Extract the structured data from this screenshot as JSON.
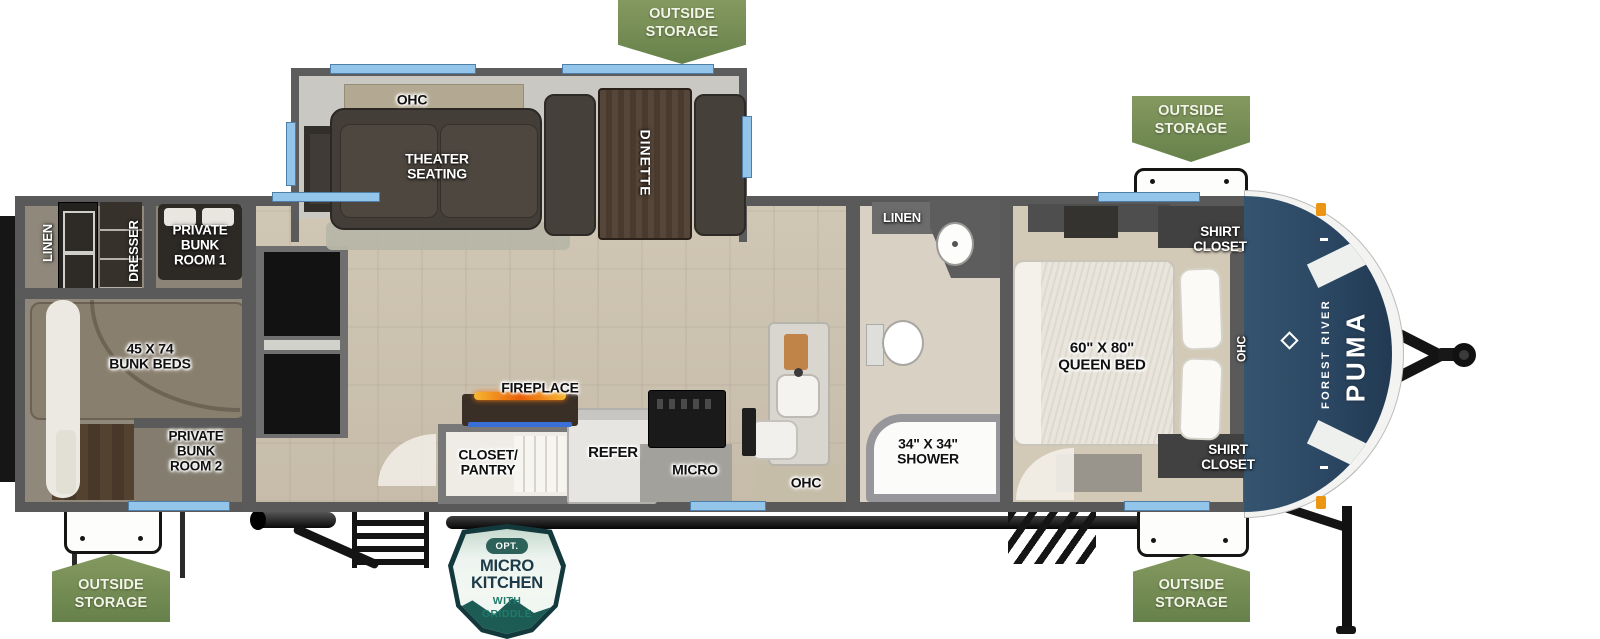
{
  "brand": {
    "maker": "FOREST RIVER",
    "model": "PUMA"
  },
  "badges": {
    "outside_storage": "OUTSIDE\nSTORAGE"
  },
  "option_badge": {
    "opt": "OPT.",
    "title": "MICRO\nKITCHEN",
    "subtitle": "WITH\nGRIDDLE"
  },
  "labels": {
    "linen_bunkhouse": "LINEN",
    "dresser": "DRESSER",
    "private_bunk_room_1": "PRIVATE\nBUNK\nROOM 1",
    "bunk_beds": "45 X 74\nBUNK BEDS",
    "private_bunk_room_2": "PRIVATE\nBUNK\nROOM 2",
    "ohc_slideout": "OHC",
    "theater_seating": "THEATER\nSEATING",
    "dinette": "DINETTE",
    "fireplace": "FIREPLACE",
    "closet_pantry": "CLOSET/\nPANTRY",
    "refer": "REFER",
    "micro": "MICRO",
    "ohc_kitchen": "OHC",
    "linen_bathroom": "LINEN",
    "shower": "34\" X 34\"\nSHOWER",
    "queen_bed": "60\" X 80\"\nQUEEN BED",
    "shirt_closet_top": "SHIRT\nCLOSET",
    "shirt_closet_bottom": "SHIRT\nCLOSET",
    "ohc_bedroom": "OHC"
  },
  "colors": {
    "badge_green": "#73904f",
    "window_blue": "#93c4e9",
    "wall_gray": "#5a5a5a",
    "front_cap_blue": "#2e4d6d",
    "marker_orange": "#ec9414",
    "fireplace_flame": "#e85d04",
    "fireplace_led": "#3a6fd8",
    "option_badge_teal": "#1d5c55",
    "option_badge_navy": "#1c3a47"
  }
}
